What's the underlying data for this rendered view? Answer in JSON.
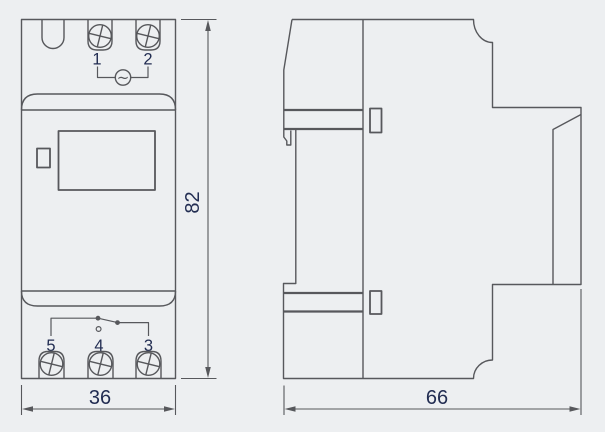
{
  "front_view": {
    "top_terminals": [
      {
        "label": "1"
      },
      {
        "label": "2"
      }
    ],
    "ac_symbol": "~",
    "bottom_terminals": [
      {
        "label": "5"
      },
      {
        "label": "4"
      },
      {
        "label": "3"
      }
    ]
  },
  "dimensions": {
    "height": "82",
    "width": "36",
    "depth": "66"
  },
  "colors": {
    "background": "#edeff1",
    "line": "#57585c",
    "label": "#222d52"
  }
}
